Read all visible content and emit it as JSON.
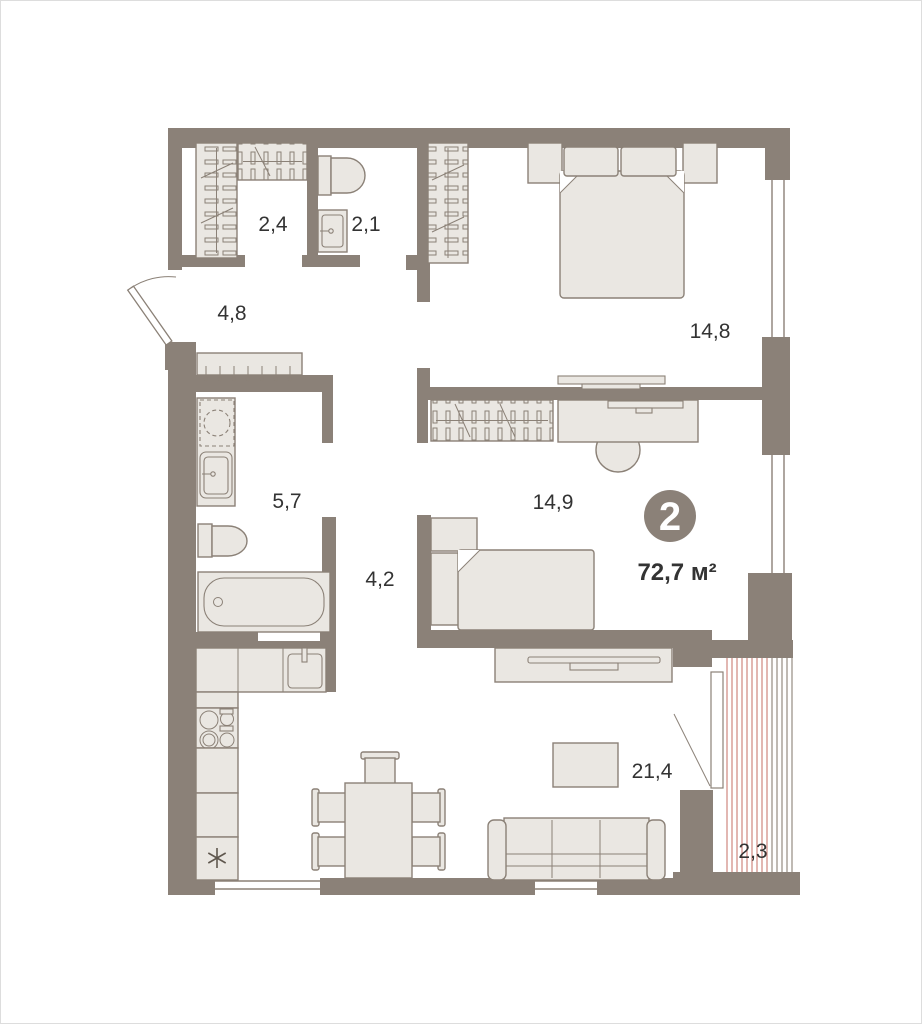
{
  "plan": {
    "badge": {
      "room_count": "2",
      "total_area": "72,7 м²"
    },
    "room_areas": {
      "entry_wardrobe": "2,4",
      "wc": "2,1",
      "hallway": "4,8",
      "bedroom_main": "14,8",
      "bathroom": "5,7",
      "bedroom_second": "14,9",
      "corridor": "4,2",
      "living_kitchen": "21,4",
      "balcony": "2,3"
    },
    "icons": {
      "fridge": "snowflake-icon",
      "entry": "door-swing-arc",
      "balcony_door": "door-swing-line"
    },
    "colors": {
      "wall": "#8b8178",
      "furniture_fill": "#eae7e2",
      "furniture_line": "#8b8177",
      "balcony_stripe": "#c97c74",
      "text": "#333333",
      "badge_bg": "#8b8178",
      "badge_text": "#ffffff"
    }
  }
}
